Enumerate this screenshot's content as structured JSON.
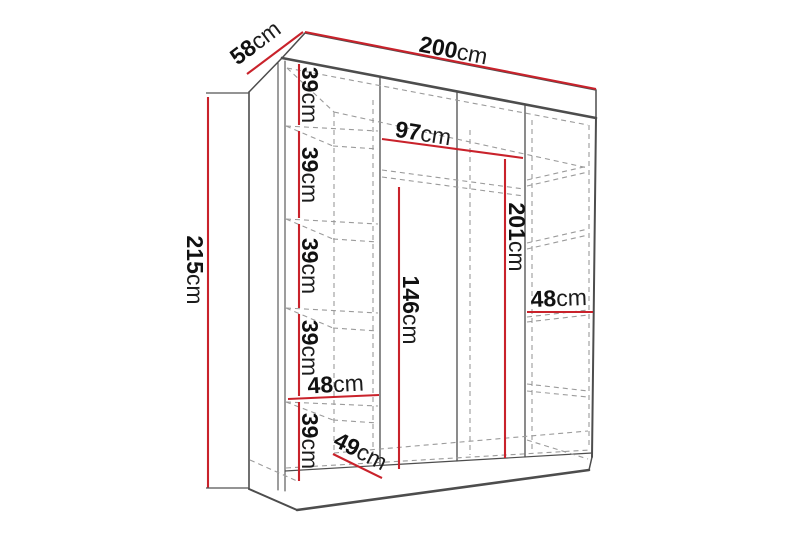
{
  "diagram": {
    "type": "furniture-dimension-diagram",
    "subject": "wardrobe with shelves, perspective line drawing"
  },
  "colors": {
    "measure_line": "#c9222b",
    "structure_edge": "#4d4d4d",
    "hidden_edge_dashed": "#9b9b9b",
    "label_text": "#111111",
    "background": "#ffffff"
  },
  "labels": {
    "width": {
      "num": "200",
      "unit": "cm"
    },
    "depth": {
      "num": "58",
      "unit": "cm"
    },
    "height": {
      "num": "215",
      "unit": "cm"
    },
    "shelf_gap_1": {
      "num": "39",
      "unit": "cm"
    },
    "shelf_gap_2": {
      "num": "39",
      "unit": "cm"
    },
    "shelf_gap_3": {
      "num": "39",
      "unit": "cm"
    },
    "shelf_gap_4": {
      "num": "39",
      "unit": "cm"
    },
    "shelf_gap_5": {
      "num": "39",
      "unit": "cm"
    },
    "left_col_width": {
      "num": "48",
      "unit": "cm"
    },
    "floor_depth": {
      "num": "49",
      "unit": "cm"
    },
    "mid_width": {
      "num": "97",
      "unit": "cm"
    },
    "hang_height": {
      "num": "146",
      "unit": "cm"
    },
    "interior_height": {
      "num": "201",
      "unit": "cm"
    },
    "right_col_width": {
      "num": "48",
      "unit": "cm"
    }
  }
}
